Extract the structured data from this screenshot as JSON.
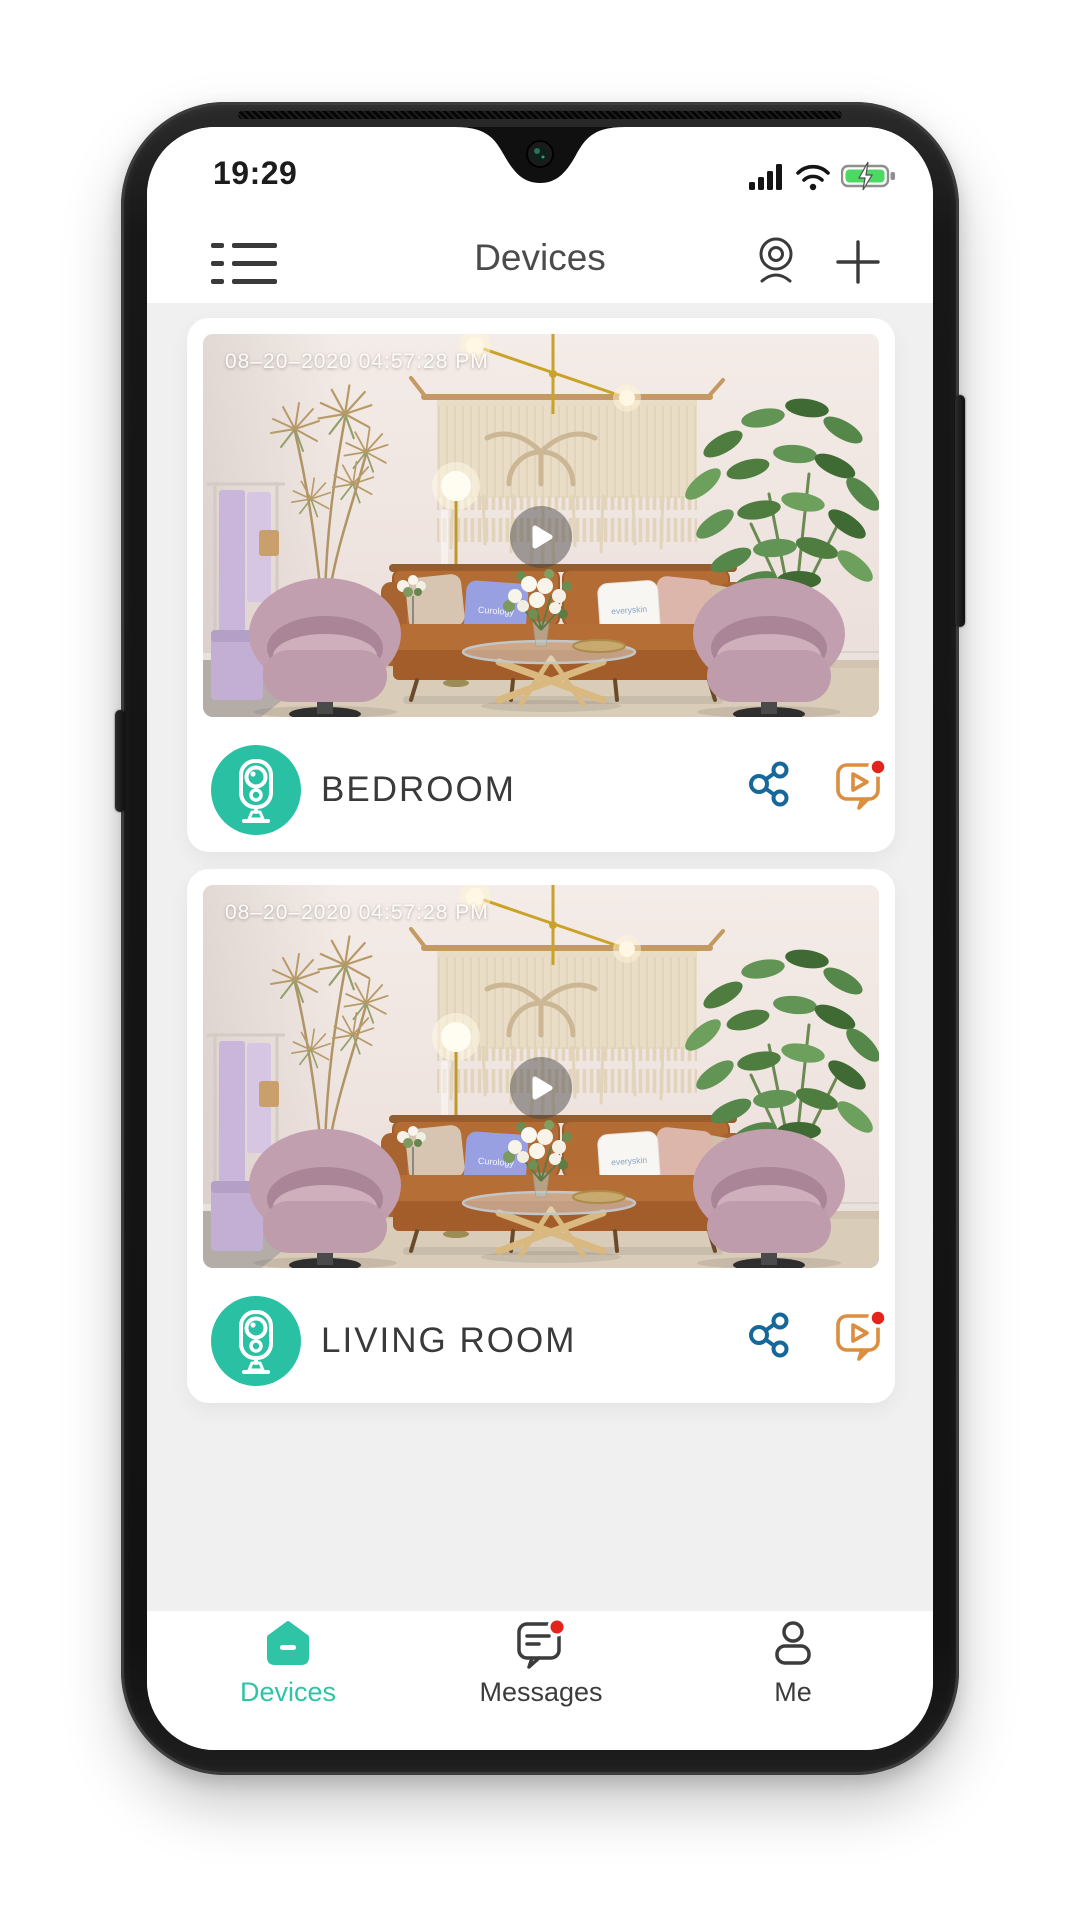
{
  "status_bar": {
    "time": "19:29",
    "icons": [
      "signal-icon",
      "wifi-icon",
      "battery-charging-icon"
    ]
  },
  "header": {
    "title": "Devices",
    "icons": [
      "menu-list-icon",
      "webcam-icon",
      "plus-icon"
    ]
  },
  "cards": [
    {
      "name": "BEDROOM",
      "timestamp": "08–20–2020 04:57:28 PM",
      "has_alert": true
    },
    {
      "name": "LIVING ROOM",
      "timestamp": "08–20–2020 04:57:28 PM",
      "has_alert": true
    }
  ],
  "scene": {
    "pillow_left_text": "Curology",
    "pillow_right_text": "everyskin"
  },
  "tabs": [
    {
      "label": "Devices",
      "active": true,
      "badge": false
    },
    {
      "label": "Messages",
      "active": false,
      "badge": true
    },
    {
      "label": "Me",
      "active": false,
      "badge": false
    }
  ],
  "colors": {
    "accent_teal": "#29c0a3",
    "tab_teal": "#2ec4a5",
    "share_blue": "#16689b",
    "chat_orange": "#db8e3f",
    "badge_red": "#e3241b",
    "battery_green": "#4cd963",
    "content_bg": "#f0f0f1",
    "name_text": "#3a3a3a"
  }
}
